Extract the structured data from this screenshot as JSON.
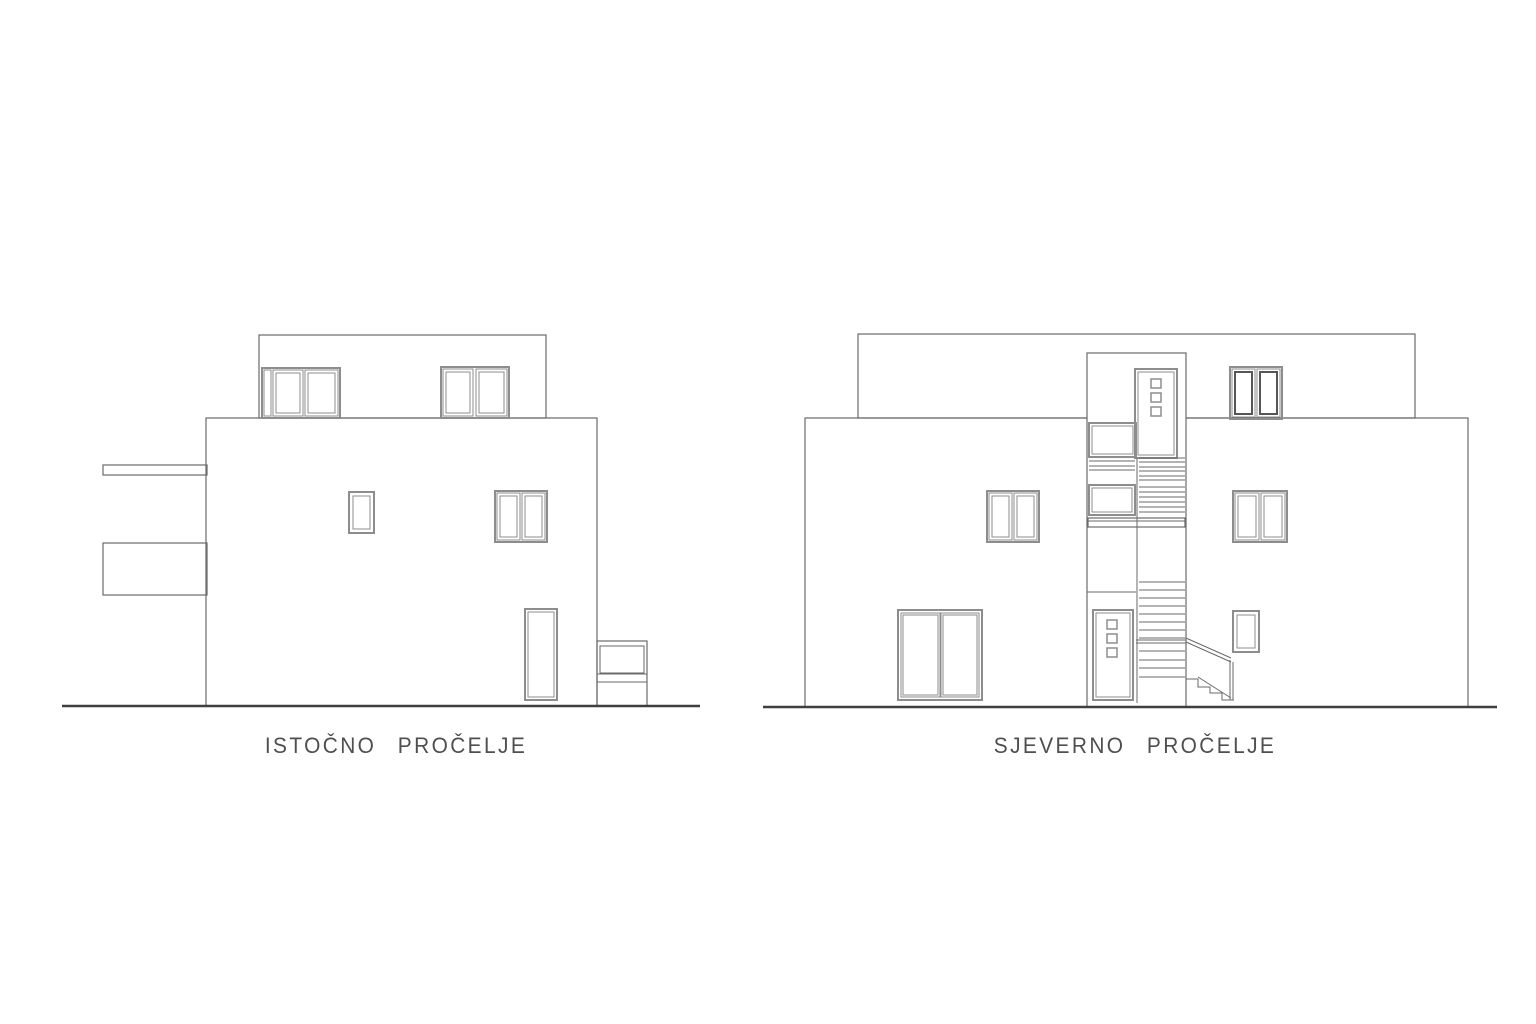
{
  "colors": {
    "background": "#ffffff",
    "line": "#6a6a6a",
    "frame": "#8d8d8d",
    "frameDark": "#565656",
    "dark": "#3f3f3f",
    "text": "#4f4f4f"
  },
  "drawings": [
    {
      "id": "east-elevation",
      "label": "ISTOČNO PROČELJE",
      "shapes": {
        "rects": [
          {
            "x": 206,
            "y": 418,
            "w": 391,
            "h": 288
          },
          {
            "x": 259,
            "y": 335,
            "w": 287,
            "h": 83
          },
          {
            "x": 103,
            "y": 465,
            "w": 104,
            "h": 10
          },
          {
            "x": 103,
            "y": 543,
            "w": 104,
            "h": 52
          },
          {
            "x": 597,
            "y": 641,
            "w": 50,
            "h": 65
          },
          {
            "x": 600,
            "y": 646,
            "w": 44,
            "h": 27,
            "sw": 1
          },
          {
            "x": 262,
            "y": 368,
            "w": 78,
            "h": 50,
            "s": "frame",
            "sw": 2
          },
          {
            "x": 264,
            "y": 370,
            "w": 7,
            "h": 46,
            "s": "frame",
            "sw": 1
          },
          {
            "x": 273,
            "y": 370,
            "w": 30,
            "h": 46,
            "s": "frame",
            "sw": 1
          },
          {
            "x": 276,
            "y": 373,
            "w": 24,
            "h": 40,
            "s": "frame",
            "sw": 1
          },
          {
            "x": 305,
            "y": 370,
            "w": 33,
            "h": 46,
            "s": "frame",
            "sw": 1
          },
          {
            "x": 308,
            "y": 373,
            "w": 27,
            "h": 40,
            "s": "frame",
            "sw": 1
          },
          {
            "x": 441,
            "y": 367,
            "w": 68,
            "h": 51,
            "s": "frame",
            "sw": 2
          },
          {
            "x": 443,
            "y": 369,
            "w": 30,
            "h": 47,
            "s": "frame",
            "sw": 1
          },
          {
            "x": 446,
            "y": 372,
            "w": 24,
            "h": 41,
            "s": "frame",
            "sw": 1
          },
          {
            "x": 476,
            "y": 369,
            "w": 31,
            "h": 47,
            "s": "frame",
            "sw": 1
          },
          {
            "x": 479,
            "y": 372,
            "w": 25,
            "h": 41,
            "s": "frame",
            "sw": 1
          },
          {
            "x": 349,
            "y": 492,
            "w": 25,
            "h": 41,
            "s": "frame",
            "sw": 2
          },
          {
            "x": 353,
            "y": 496,
            "w": 17,
            "h": 33,
            "s": "frame",
            "sw": 1
          },
          {
            "x": 495,
            "y": 491,
            "w": 52,
            "h": 51,
            "s": "frame",
            "sw": 2
          },
          {
            "x": 497,
            "y": 493,
            "w": 23,
            "h": 47,
            "s": "frame",
            "sw": 1
          },
          {
            "x": 500,
            "y": 496,
            "w": 17,
            "h": 41,
            "s": "frame",
            "sw": 1
          },
          {
            "x": 522,
            "y": 493,
            "w": 23,
            "h": 47,
            "s": "frame",
            "sw": 1
          },
          {
            "x": 525,
            "y": 496,
            "w": 17,
            "h": 41,
            "s": "frame",
            "sw": 1
          },
          {
            "x": 525,
            "y": 609,
            "w": 32,
            "h": 91,
            "s": "frame",
            "sw": 2
          },
          {
            "x": 528,
            "y": 612,
            "w": 26,
            "h": 85,
            "s": "frame",
            "sw": 1
          }
        ],
        "lines": [
          {
            "x1": 597,
            "y1": 674,
            "x2": 647,
            "y2": 674
          },
          {
            "x1": 597,
            "y1": 682,
            "x2": 647,
            "y2": 682
          },
          {
            "x1": 62,
            "y1": 706,
            "x2": 700,
            "y2": 706,
            "s": "dark",
            "sw": 2.5
          }
        ],
        "polylines": []
      }
    },
    {
      "id": "north-elevation",
      "label": "SJEVERNO PROČELJE",
      "shapes": {
        "rects": [
          {
            "x": 805,
            "y": 418,
            "w": 663,
            "h": 289
          },
          {
            "x": 858,
            "y": 334,
            "w": 557,
            "h": 84
          },
          {
            "x": 1087,
            "y": 353,
            "w": 99,
            "h": 354,
            "f": "background"
          },
          {
            "x": 1135,
            "y": 369,
            "w": 42,
            "h": 89,
            "s": "frame",
            "sw": 2
          },
          {
            "x": 1138,
            "y": 372,
            "w": 36,
            "h": 83,
            "s": "frame",
            "sw": 1
          },
          {
            "x": 1151,
            "y": 379,
            "w": 10,
            "h": 9,
            "s": "frame",
            "sw": 1.5
          },
          {
            "x": 1151,
            "y": 393,
            "w": 10,
            "h": 9,
            "s": "frame",
            "sw": 1.5
          },
          {
            "x": 1151,
            "y": 407,
            "w": 10,
            "h": 9,
            "s": "frame",
            "sw": 1.5
          },
          {
            "x": 1089,
            "y": 423,
            "w": 47,
            "h": 34,
            "s": "frame",
            "sw": 2
          },
          {
            "x": 1092,
            "y": 426,
            "w": 41,
            "h": 28,
            "s": "frame",
            "sw": 1
          },
          {
            "x": 1089,
            "y": 485,
            "w": 46,
            "h": 30,
            "s": "frame",
            "sw": 2
          },
          {
            "x": 1092,
            "y": 488,
            "w": 40,
            "h": 24,
            "s": "frame",
            "sw": 1
          },
          {
            "x": 1088,
            "y": 518,
            "w": 97,
            "h": 9
          },
          {
            "x": 1093,
            "y": 610,
            "w": 40,
            "h": 90,
            "s": "frame",
            "sw": 2
          },
          {
            "x": 1096,
            "y": 613,
            "w": 34,
            "h": 84,
            "s": "frame",
            "sw": 1
          },
          {
            "x": 1107,
            "y": 620,
            "w": 10,
            "h": 9,
            "s": "frame",
            "sw": 1.5
          },
          {
            "x": 1107,
            "y": 634,
            "w": 10,
            "h": 9,
            "s": "frame",
            "sw": 1.5
          },
          {
            "x": 1107,
            "y": 648,
            "w": 10,
            "h": 9,
            "s": "frame",
            "sw": 1.5
          },
          {
            "x": 987,
            "y": 491,
            "w": 52,
            "h": 51,
            "s": "frame",
            "sw": 2
          },
          {
            "x": 989,
            "y": 493,
            "w": 23,
            "h": 47,
            "s": "frame",
            "sw": 1
          },
          {
            "x": 992,
            "y": 496,
            "w": 17,
            "h": 41,
            "s": "frame",
            "sw": 1
          },
          {
            "x": 1014,
            "y": 493,
            "w": 23,
            "h": 47,
            "s": "frame",
            "sw": 1
          },
          {
            "x": 1017,
            "y": 496,
            "w": 17,
            "h": 41,
            "s": "frame",
            "sw": 1
          },
          {
            "x": 1233,
            "y": 491,
            "w": 54,
            "h": 51,
            "s": "frame",
            "sw": 2
          },
          {
            "x": 1235,
            "y": 493,
            "w": 24,
            "h": 47,
            "s": "frame",
            "sw": 1
          },
          {
            "x": 1238,
            "y": 496,
            "w": 18,
            "h": 41,
            "s": "frame",
            "sw": 1
          },
          {
            "x": 1261,
            "y": 493,
            "w": 24,
            "h": 47,
            "s": "frame",
            "sw": 1
          },
          {
            "x": 1264,
            "y": 496,
            "w": 18,
            "h": 41,
            "s": "frame",
            "sw": 1
          },
          {
            "x": 1230,
            "y": 367,
            "w": 52,
            "h": 52,
            "s": "frame",
            "sw": 2
          },
          {
            "x": 1232,
            "y": 369,
            "w": 23,
            "h": 48,
            "s": "frame",
            "sw": 1
          },
          {
            "x": 1235,
            "y": 372,
            "w": 17,
            "h": 42,
            "s": "frameDark",
            "sw": 2
          },
          {
            "x": 1257,
            "y": 369,
            "w": 23,
            "h": 48,
            "s": "frame",
            "sw": 1
          },
          {
            "x": 1260,
            "y": 372,
            "w": 17,
            "h": 42,
            "s": "frameDark",
            "sw": 2
          },
          {
            "x": 898,
            "y": 610,
            "w": 84,
            "h": 90,
            "s": "frame",
            "sw": 2
          },
          {
            "x": 901,
            "y": 613,
            "w": 39,
            "h": 84,
            "s": "frame",
            "sw": 1
          },
          {
            "x": 903,
            "y": 615,
            "w": 35,
            "h": 80,
            "s": "frame",
            "sw": 1
          },
          {
            "x": 941,
            "y": 613,
            "w": 38,
            "h": 84,
            "s": "frame",
            "sw": 1
          },
          {
            "x": 943,
            "y": 615,
            "w": 34,
            "h": 80,
            "s": "frame",
            "sw": 1
          },
          {
            "x": 1233,
            "y": 611,
            "w": 26,
            "h": 41,
            "s": "frame",
            "sw": 2
          },
          {
            "x": 1237,
            "y": 615,
            "w": 18,
            "h": 33,
            "s": "frame",
            "sw": 1
          }
        ],
        "lines": [
          {
            "x1": 1137,
            "y1": 458,
            "x2": 1137,
            "y2": 703
          },
          {
            "x1": 1087,
            "y1": 592,
            "x2": 1136,
            "y2": 592
          },
          {
            "x1": 1089,
            "y1": 461,
            "x2": 1135,
            "y2": 461
          },
          {
            "x1": 1089,
            "y1": 466,
            "x2": 1135,
            "y2": 466
          },
          {
            "x1": 1089,
            "y1": 470,
            "x2": 1135,
            "y2": 470
          },
          {
            "x1": 1139,
            "y1": 458,
            "x2": 1185,
            "y2": 458
          },
          {
            "x1": 1139,
            "y1": 462,
            "x2": 1185,
            "y2": 462
          },
          {
            "x1": 1139,
            "y1": 467,
            "x2": 1185,
            "y2": 467
          },
          {
            "x1": 1139,
            "y1": 471,
            "x2": 1185,
            "y2": 471
          },
          {
            "x1": 1139,
            "y1": 476,
            "x2": 1185,
            "y2": 476
          },
          {
            "x1": 1139,
            "y1": 480,
            "x2": 1185,
            "y2": 480
          },
          {
            "x1": 1139,
            "y1": 487,
            "x2": 1185,
            "y2": 487
          },
          {
            "x1": 1139,
            "y1": 492,
            "x2": 1185,
            "y2": 492
          },
          {
            "x1": 1139,
            "y1": 497,
            "x2": 1185,
            "y2": 497
          },
          {
            "x1": 1139,
            "y1": 502,
            "x2": 1185,
            "y2": 502
          },
          {
            "x1": 1139,
            "y1": 507,
            "x2": 1185,
            "y2": 507
          },
          {
            "x1": 1139,
            "y1": 512,
            "x2": 1185,
            "y2": 512
          },
          {
            "x1": 1088,
            "y1": 521,
            "x2": 1185,
            "y2": 521
          },
          {
            "x1": 1139,
            "y1": 582,
            "x2": 1185,
            "y2": 582
          },
          {
            "x1": 1139,
            "y1": 590,
            "x2": 1185,
            "y2": 590
          },
          {
            "x1": 1139,
            "y1": 598,
            "x2": 1185,
            "y2": 598
          },
          {
            "x1": 1139,
            "y1": 606,
            "x2": 1185,
            "y2": 606
          },
          {
            "x1": 1139,
            "y1": 614,
            "x2": 1185,
            "y2": 614
          },
          {
            "x1": 1139,
            "y1": 622,
            "x2": 1185,
            "y2": 622
          },
          {
            "x1": 1139,
            "y1": 630,
            "x2": 1185,
            "y2": 630
          },
          {
            "x1": 1139,
            "y1": 638,
            "x2": 1185,
            "y2": 638
          },
          {
            "x1": 1136,
            "y1": 640,
            "x2": 1186,
            "y2": 640
          },
          {
            "x1": 1136,
            "y1": 643,
            "x2": 1186,
            "y2": 643
          },
          {
            "x1": 1139,
            "y1": 651,
            "x2": 1185,
            "y2": 651
          },
          {
            "x1": 1139,
            "y1": 660,
            "x2": 1185,
            "y2": 660
          },
          {
            "x1": 1139,
            "y1": 668,
            "x2": 1185,
            "y2": 668
          },
          {
            "x1": 1139,
            "y1": 677,
            "x2": 1185,
            "y2": 677
          },
          {
            "x1": 1186,
            "y1": 638,
            "x2": 1231,
            "y2": 658
          },
          {
            "x1": 1186,
            "y1": 642,
            "x2": 1231,
            "y2": 662
          },
          {
            "x1": 1198,
            "y1": 677,
            "x2": 1231,
            "y2": 698
          },
          {
            "x1": 1230,
            "y1": 660,
            "x2": 1230,
            "y2": 700
          },
          {
            "x1": 1233,
            "y1": 662,
            "x2": 1233,
            "y2": 700
          },
          {
            "x1": 763,
            "y1": 707,
            "x2": 1497,
            "y2": 707,
            "s": "dark",
            "sw": 2.5
          }
        ],
        "polylines": [
          {
            "pts": [
              [
                1186,
                679
              ],
              [
                1198,
                679
              ],
              [
                1198,
                687
              ],
              [
                1210,
                687
              ],
              [
                1210,
                693
              ],
              [
                1222,
                693
              ],
              [
                1222,
                700
              ],
              [
                1234,
                700
              ]
            ],
            "sw": 1
          }
        ]
      }
    }
  ]
}
